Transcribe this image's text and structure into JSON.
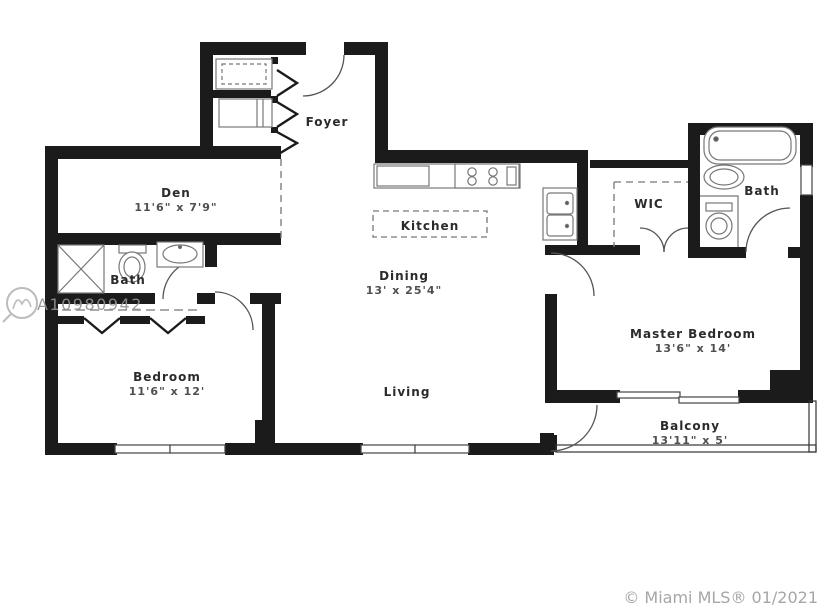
{
  "watermark": {
    "id": "A10980942"
  },
  "footer": {
    "copyright": "© Miami MLS® 01/2021"
  },
  "colors": {
    "wall": "#1b1b1b",
    "fixture": "#777777",
    "door": "#555555",
    "dashed": "#777777",
    "label": "#2b2b2b",
    "dims": "#4f4f4f",
    "watermark": "#929292",
    "copyright": "#a6a6a6",
    "background": "#ffffff"
  },
  "rooms": {
    "foyer": {
      "label": "Foyer",
      "dims": ""
    },
    "den": {
      "label": "Den",
      "dims": "11'6\" x 7'9\""
    },
    "kitchen": {
      "label": "Kitchen",
      "dims": ""
    },
    "dining": {
      "label": "Dining",
      "dims": "13' x 25'4\""
    },
    "living": {
      "label": "Living",
      "dims": ""
    },
    "bath_left": {
      "label": "Bath",
      "dims": ""
    },
    "bedroom": {
      "label": "Bedroom",
      "dims": "11'6\" x 12'"
    },
    "wic": {
      "label": "WIC",
      "dims": ""
    },
    "bath_master": {
      "label": "Bath",
      "dims": ""
    },
    "master_bedroom": {
      "label": "Master Bedroom",
      "dims": "13'6\" x 14'"
    },
    "balcony": {
      "label": "Balcony",
      "dims": "13'11\" x 5'"
    }
  }
}
